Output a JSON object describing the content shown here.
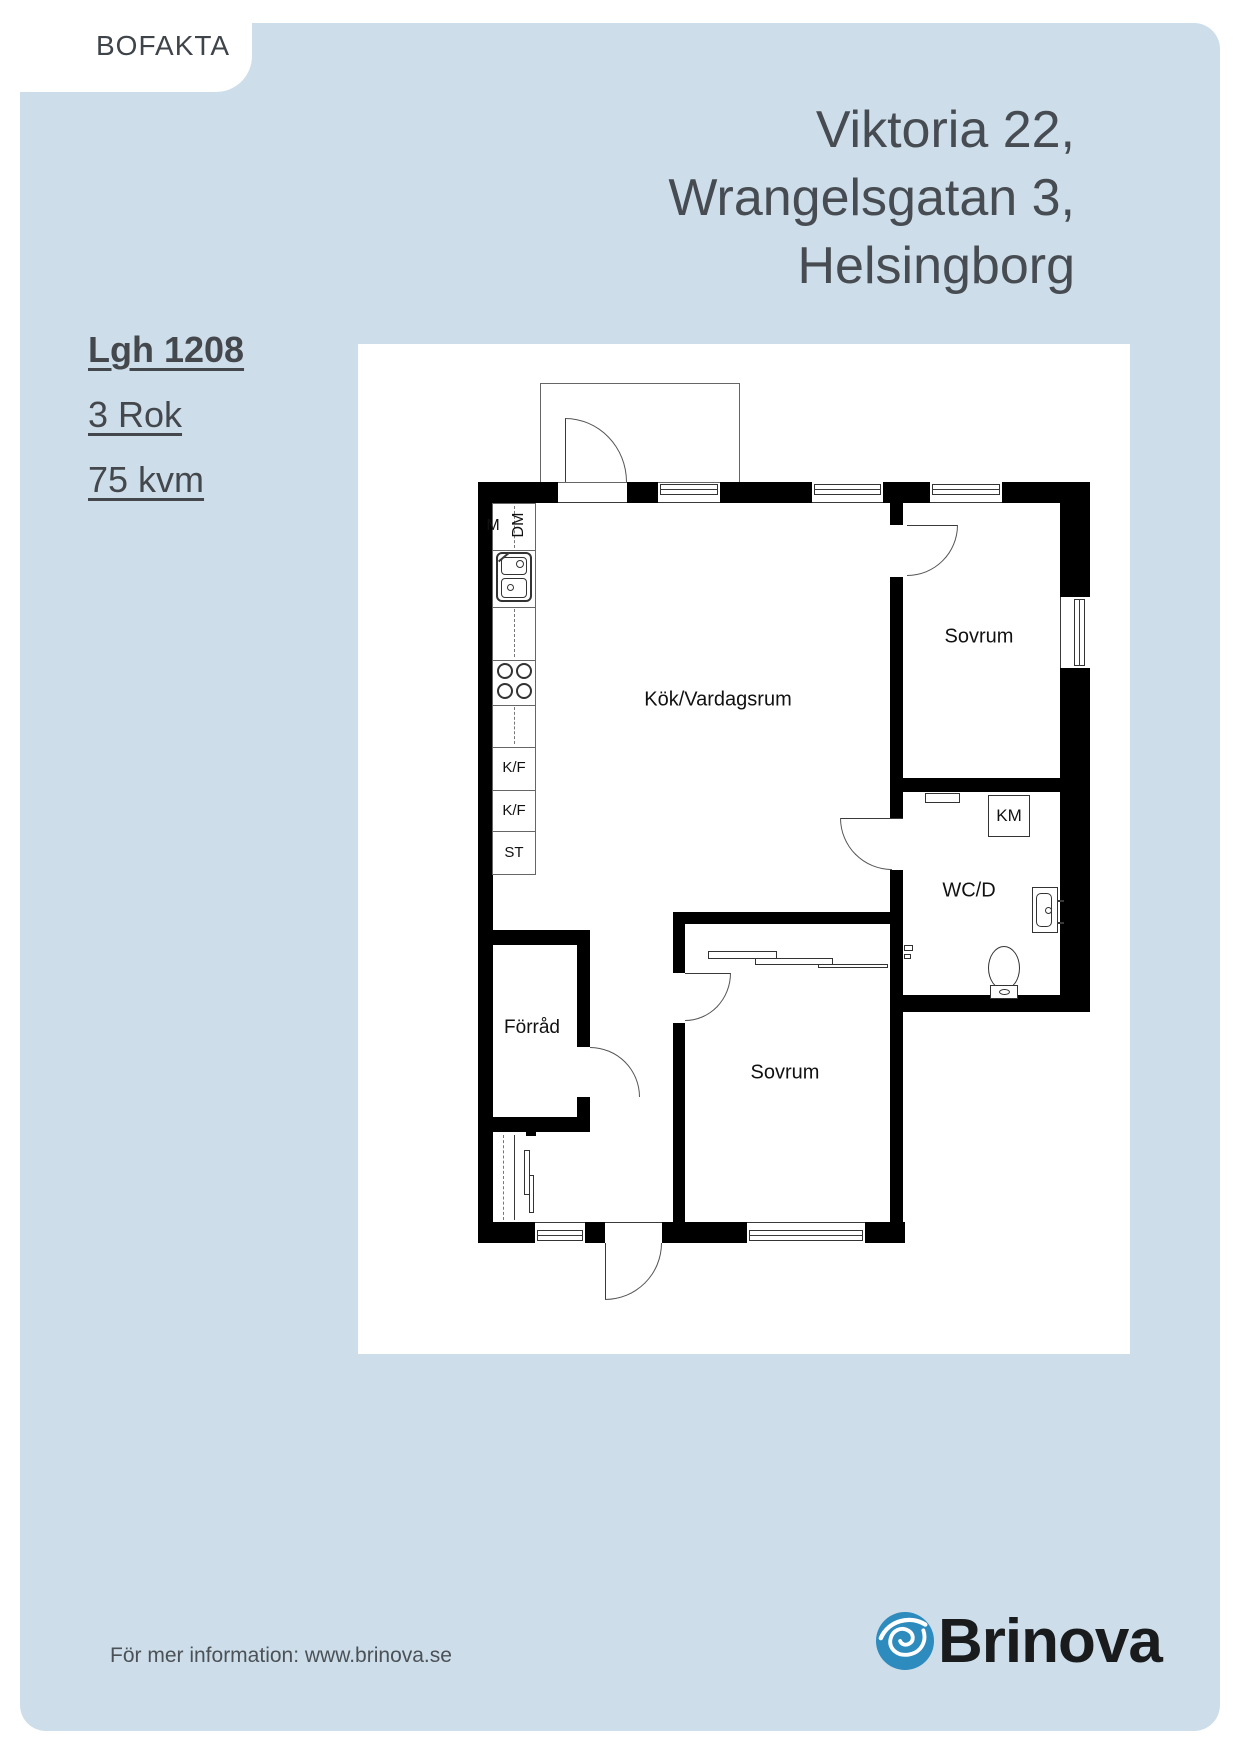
{
  "page": {
    "tab_label": "BOFAKTA",
    "title_lines": [
      "Viktoria 22,",
      "Wrangelsgatan 3,",
      "Helsingborg"
    ],
    "apartment": {
      "id": "Lgh 1208",
      "rooms": "3 Rok",
      "area": "75 kvm"
    }
  },
  "plan": {
    "labels": {
      "kitchen_living": "Kök/Vardagsrum",
      "bedroom_top": "Sovrum",
      "bedroom_bottom": "Sovrum",
      "wc": "WC/D",
      "storage": "Förråd",
      "washer": "KM",
      "micro": "M",
      "dishwasher": "DM",
      "fridge1": "K/F",
      "fridge2": "K/F",
      "pantry": "ST"
    }
  },
  "footer": {
    "info": "För mer information: www.brinova.se",
    "brand": "Brinova"
  },
  "colors": {
    "background_blue": "#cddeea",
    "logo_blue": "#2e8bbd",
    "text_dark": "#474c52",
    "plan_black": "#000000"
  }
}
